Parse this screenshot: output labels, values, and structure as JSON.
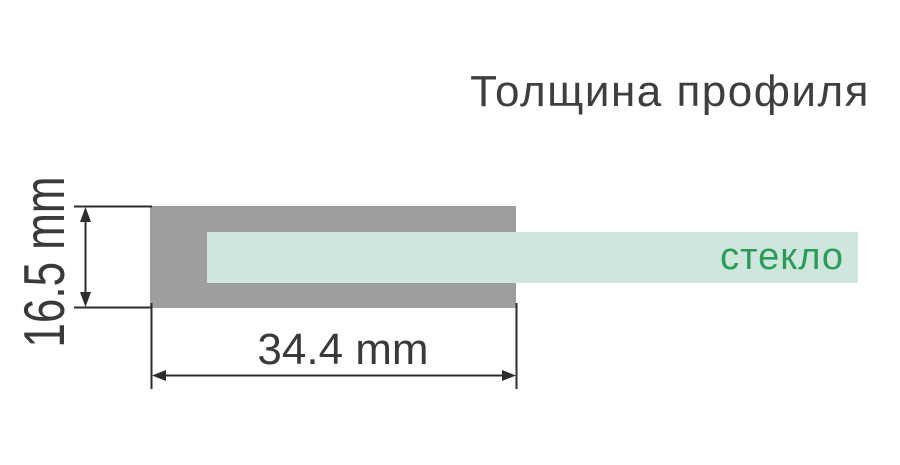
{
  "title": "Толщина профиля",
  "diagram": {
    "glass_label": "стекло",
    "dimensions": {
      "width": {
        "label": "34.4 mm",
        "value": 34.4,
        "unit": "mm"
      },
      "height": {
        "label": "16.5 mm",
        "value": 16.5,
        "unit": "mm"
      }
    }
  },
  "colors": {
    "background": "#ffffff",
    "profile-gray": "#9e9e9e",
    "glass-mint": "#cee6de",
    "glass-green": "#2a9c56",
    "title-dark": "#3e3e3e",
    "text-dark": "#3a3a3a",
    "dimension-dark": "#2d2d2d"
  }
}
